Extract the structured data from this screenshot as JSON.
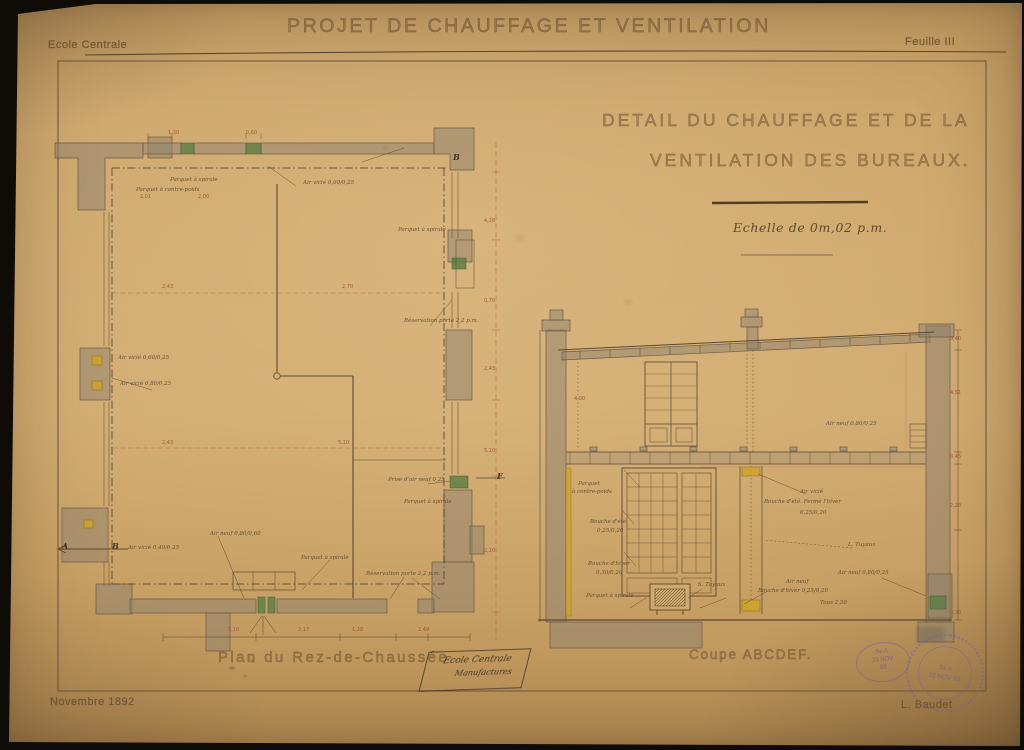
{
  "header": {
    "school": "Ecole Centrale",
    "title": "PROJET DE CHAUFFAGE ET VENTILATION",
    "sheet": "Feuille III"
  },
  "subtitle": {
    "line1": "DETAIL DU CHAUFFAGE  ET DE LA",
    "line2": "VENTILATION DES BUREAUX.",
    "scale": "Echelle de 0m,02 p.m."
  },
  "footer": {
    "date": "Novembre 1892",
    "author": "L. Baudet"
  },
  "plan": {
    "caption": "Plan du Rez-de-Chaussée",
    "annotations": [
      {
        "text": "Parquet à spirale",
        "x": 170,
        "y": 177
      },
      {
        "text": "Parquet à contre-poids",
        "x": 136,
        "y": 187
      },
      {
        "text": "Air vicié 0,60/0,25",
        "x": 303,
        "y": 180
      },
      {
        "text": "Parquet à spirale",
        "x": 398,
        "y": 227
      },
      {
        "text": "Réservation porte 2,2 p.m.",
        "x": 404,
        "y": 318
      },
      {
        "text": "Air vicié 0,60/0,25",
        "x": 118,
        "y": 355
      },
      {
        "text": "Air vicié 0,80/0,25",
        "x": 120,
        "y": 381
      },
      {
        "text": "Air vicié 0,40/0,25",
        "x": 128,
        "y": 545
      },
      {
        "text": "Air neuf 0,80/0,60",
        "x": 210,
        "y": 531
      },
      {
        "text": "Parquet à spirale",
        "x": 301,
        "y": 555
      },
      {
        "text": "Réservation porte 2,2 p.m.",
        "x": 366,
        "y": 571
      },
      {
        "text": "Prise d'air neuf 0,25",
        "x": 388,
        "y": 477
      },
      {
        "text": "Parquet à spirale",
        "x": 404,
        "y": 499
      },
      {
        "text": "A",
        "x": 62,
        "y": 541,
        "cls": "letter"
      },
      {
        "text": "B",
        "x": 112,
        "y": 541,
        "cls": "letter"
      },
      {
        "text": "F",
        "x": 497,
        "y": 471,
        "cls": "letter"
      },
      {
        "text": "B",
        "x": 453,
        "y": 152,
        "cls": "letter"
      }
    ],
    "dimensions": [
      {
        "text": "2,01",
        "x": 140,
        "y": 194
      },
      {
        "text": "2,00",
        "x": 198,
        "y": 194
      },
      {
        "text": "2,43",
        "x": 162,
        "y": 284
      },
      {
        "text": "2,70",
        "x": 342,
        "y": 284
      },
      {
        "text": "2,43",
        "x": 162,
        "y": 440
      },
      {
        "text": "5,10",
        "x": 338,
        "y": 440
      },
      {
        "text": "5,10",
        "x": 228,
        "y": 627
      },
      {
        "text": "2,17",
        "x": 298,
        "y": 627
      },
      {
        "text": "1,28",
        "x": 352,
        "y": 627
      },
      {
        "text": "2,49",
        "x": 418,
        "y": 627
      },
      {
        "text": "4,28",
        "x": 484,
        "y": 218
      },
      {
        "text": "0,70",
        "x": 484,
        "y": 298
      },
      {
        "text": "2,43",
        "x": 484,
        "y": 366
      },
      {
        "text": "5,10",
        "x": 484,
        "y": 448
      },
      {
        "text": "2,20",
        "x": 484,
        "y": 548
      },
      {
        "text": "0,60",
        "x": 246,
        "y": 130
      },
      {
        "text": "1,30",
        "x": 168,
        "y": 130
      }
    ]
  },
  "section": {
    "caption": "Coupe ABCDEF.",
    "annotations": [
      {
        "text": "Parquet",
        "x": 578,
        "y": 481
      },
      {
        "text": "à contre-poids",
        "x": 572,
        "y": 489
      },
      {
        "text": "Bouche d'été",
        "x": 590,
        "y": 519
      },
      {
        "text": "0,25/0,20",
        "x": 597,
        "y": 528
      },
      {
        "text": "Bouche d'hiver",
        "x": 588,
        "y": 561
      },
      {
        "text": "0,30/0,20",
        "x": 596,
        "y": 570
      },
      {
        "text": "Parquet à spirale",
        "x": 586,
        "y": 593
      },
      {
        "text": "S. Tuyaux",
        "x": 698,
        "y": 582
      },
      {
        "text": "Air vicié",
        "x": 800,
        "y": 489
      },
      {
        "text": "Bouche d'été. Fermé l'hiver",
        "x": 764,
        "y": 499
      },
      {
        "text": "0,25/0,20",
        "x": 800,
        "y": 510
      },
      {
        "text": "L. Tuyaux",
        "x": 848,
        "y": 542
      },
      {
        "text": "Air neuf 0,80/0,25",
        "x": 838,
        "y": 570
      },
      {
        "text": "Air neuf",
        "x": 786,
        "y": 579
      },
      {
        "text": "Bouche d'hiver 0,25/0,20",
        "x": 758,
        "y": 588
      },
      {
        "text": "Tous 2,50",
        "x": 820,
        "y": 600
      },
      {
        "text": "Air neuf 0,80/0,25",
        "x": 826,
        "y": 421
      }
    ],
    "dimensions": [
      {
        "text": "0,40",
        "x": 950,
        "y": 336
      },
      {
        "text": "4,51",
        "x": 950,
        "y": 390
      },
      {
        "text": "0,45",
        "x": 950,
        "y": 454
      },
      {
        "text": "2,20",
        "x": 950,
        "y": 503
      },
      {
        "text": "0,30",
        "x": 950,
        "y": 610
      },
      {
        "text": "4,00",
        "x": 574,
        "y": 396
      }
    ]
  },
  "stamps": {
    "office": {
      "line1": "Ecole Centrale",
      "line2": "Manufactures"
    },
    "date_stamp": {
      "line1": "5e A",
      "line2": "23 NOV",
      "line3": "93"
    },
    "round": {
      "line1": "5e A",
      "line2": "23 NOV 93"
    }
  },
  "colors": {
    "paper": "#cda569",
    "ink": "#5a4831",
    "wall": "#8d8170",
    "grille_green": "#5f7f46",
    "register_yellow": "#cea22e",
    "dimension_red": "#b05c42",
    "stamp_purple": "#7a5f9e"
  }
}
